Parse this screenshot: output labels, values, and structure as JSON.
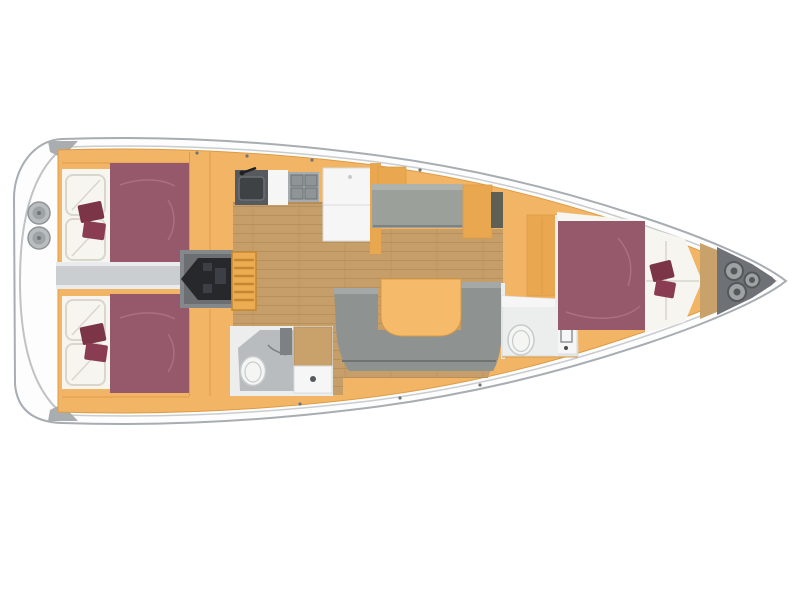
{
  "image": {
    "width": 800,
    "height": 600,
    "kind": "yacht-interior-floorplan-top-view"
  },
  "palette": {
    "background": "#ffffff",
    "hull_white": "#fdfdfd",
    "hull_outline": "#a7adb2",
    "hull_inner": "#c9cdd0",
    "transom_line": "#bfc3c6",
    "wedge_gray": "#a9adb0",
    "deck_orange": "#f2b565",
    "deck_line": "#dd9c45",
    "panel_orange": "#e9a74f",
    "wood_floor": "#c69e69",
    "wood_line": "#b18955",
    "bed_plum": "#96586b",
    "bed_fold": "#a97082",
    "cushion_dark": "#7c3447",
    "cushion_mid": "#8a3c52",
    "linen_white": "#f6f5f0",
    "linen_shadow": "#d9d6cb",
    "corridor_gray": "#cbced1",
    "corridor_edge": "#e9ebec",
    "engine_bay": "#84888b",
    "engine_bay_dark": "#6b6f72",
    "engine_black": "#26282c",
    "engine_detail": "#3c4046",
    "stairs_orange": "#ecac52",
    "stairs_line": "#c4872f",
    "sink_dark": "#565a5e",
    "sink_bowl": "#3e4245",
    "faucet_black": "#1e2023",
    "stove_gray": "#a7abae",
    "stove_grid": "#8f9497",
    "stove_line": "#6b7073",
    "white_unit": "#f5f6f5",
    "unit_line": "#d9dbdc",
    "bench_gray": "#9ba09b",
    "bench_top": "#aeb3ae",
    "bench_shadow": "#7e8381",
    "nav_olive": "#5f6054",
    "sofa_gray": "#8e9392",
    "sofa_top": "#a4a9a7",
    "sofa_shadow": "#6f7472",
    "table_orange": "#f6bb6a",
    "table_line": "#d89a43",
    "bath_wall": "#eceded",
    "bath_floor": "#b8bcbf",
    "toilet_white": "#f5f6f4",
    "toilet_line": "#c7cbcd",
    "shower_gray": "#7d8184",
    "door_wood": "#c9a26b",
    "locker_gray": "#6e7276",
    "rope_gray": "#9ea2a5",
    "rope_dark": "#54585b",
    "hatch_gray": "#b9bdc0",
    "hatch_inner": "#9ea3a6",
    "hatch_dot": "#6f7477",
    "fitting_dark": "#6f7478",
    "button_dark": "#4a4e52"
  },
  "parts": [
    {
      "name": "hull",
      "fill_ref": "hull_white"
    },
    {
      "name": "swim-platform-transom",
      "fill_ref": "hull_white"
    },
    {
      "name": "deck-hatch",
      "count": 2,
      "fill_ref": "hatch_gray"
    },
    {
      "name": "side-deck",
      "fill_ref": "deck_orange"
    },
    {
      "name": "aft-cabin-port-bed",
      "fill_ref": "bed_plum"
    },
    {
      "name": "aft-cabin-starboard-bed",
      "fill_ref": "bed_plum"
    },
    {
      "name": "accent-cushions",
      "fill_ref": "cushion_dark"
    },
    {
      "name": "stern-corridor",
      "fill_ref": "corridor_gray"
    },
    {
      "name": "engine",
      "fill_ref": "engine_black"
    },
    {
      "name": "companionway-stairs",
      "fill_ref": "stairs_orange"
    },
    {
      "name": "galley-sink",
      "fill_ref": "sink_dark"
    },
    {
      "name": "galley-stove",
      "fill_ref": "stove_gray"
    },
    {
      "name": "galley-refrigerator-counter",
      "fill_ref": "white_unit"
    },
    {
      "name": "settee-bench",
      "fill_ref": "bench_gray"
    },
    {
      "name": "nav-locker",
      "fill_ref": "nav_olive"
    },
    {
      "name": "salon-sofa",
      "fill_ref": "sofa_gray"
    },
    {
      "name": "salon-table",
      "fill_ref": "table_orange"
    },
    {
      "name": "cabin-sole-wood-floor",
      "fill_ref": "wood_floor"
    },
    {
      "name": "aft-head-toilet",
      "fill_ref": "toilet_white"
    },
    {
      "name": "aft-head-sink",
      "fill_ref": "white_unit"
    },
    {
      "name": "forward-head-toilet",
      "fill_ref": "toilet_white"
    },
    {
      "name": "forward-cabin-v-berth",
      "fill_ref": "bed_plum"
    },
    {
      "name": "anchor-locker",
      "fill_ref": "locker_gray"
    },
    {
      "name": "mooring-rope-coils",
      "count": 3,
      "fill_ref": "rope_gray"
    }
  ]
}
